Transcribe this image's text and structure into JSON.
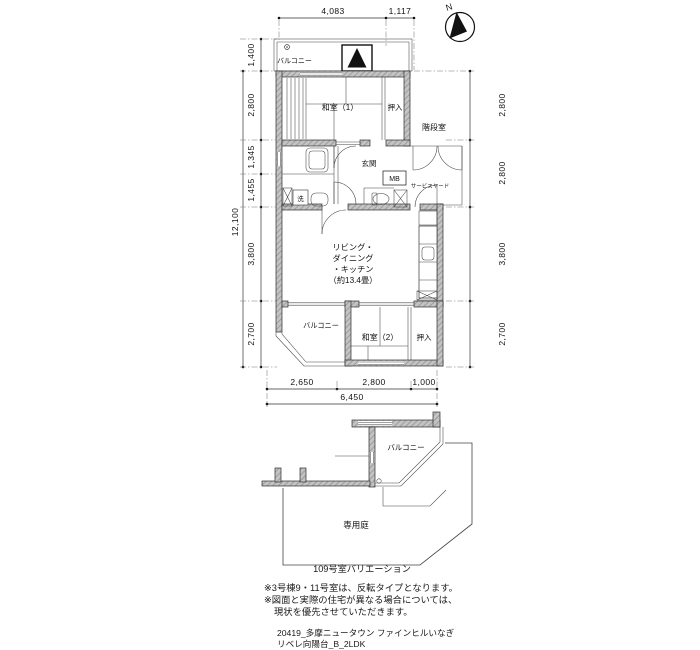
{
  "compass": {
    "n": "N"
  },
  "dims": {
    "top": [
      "4,083",
      "1,117"
    ],
    "left_total": "12,100",
    "left": [
      "1,400",
      "2,800",
      "1,345",
      "1,455",
      "3,800",
      "2,700"
    ],
    "right": [
      "2,800",
      "2,800",
      "3,800",
      "2,700"
    ],
    "bottom": [
      "2,650",
      "2,800",
      "1,000"
    ],
    "bottom_total": "6,450"
  },
  "plan": {
    "balcony_top": "バルコニー",
    "washitsu1": "和室（1）",
    "oshiire1": "押入",
    "stairwell": "階段室",
    "genkan": "玄関",
    "mb": "MB",
    "service_yard": "サービスヤード",
    "laundry": "洗",
    "ldk": [
      "リビング・",
      "ダイニング",
      "・キッチン",
      "（約13.4畳）"
    ],
    "balcony_mid": "バルコニー",
    "washitsu2": "和室（2）",
    "oshiire2": "押入"
  },
  "lower": {
    "balcony": "バルコニー",
    "garden": "専用庭",
    "caption": "109号室バリエーション"
  },
  "notes": [
    "※3号棟9・11号室は、反転タイプとなります。",
    "※図面と実際の住宅が異なる場合については、",
    "現状を優先させていただきます。"
  ],
  "footer": [
    "20419_多摩ニュータウン ファインヒルいなぎ",
    "リベレ向陽台_B_2LDK"
  ]
}
